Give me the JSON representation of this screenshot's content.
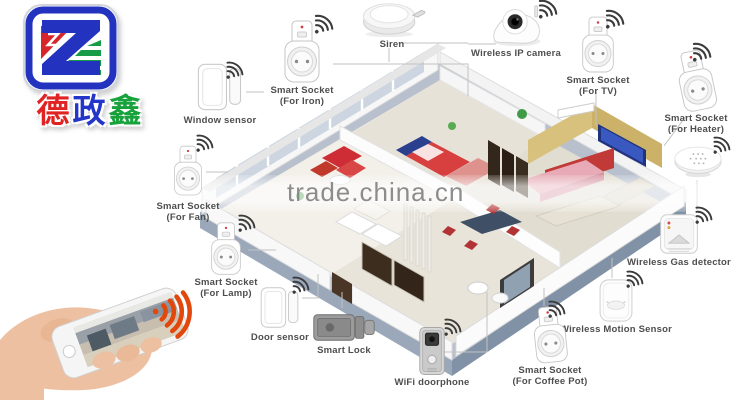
{
  "logo": {
    "letters": "ZX",
    "chars": [
      "德",
      "政",
      "鑫"
    ],
    "colors": {
      "red": "#e02323",
      "blue": "#2336c9",
      "green": "#17a23c"
    }
  },
  "watermark": {
    "text": "trade.china.cn"
  },
  "colors": {
    "wifi_icon": "#3b3b3b",
    "phone_signal": "#e2470b",
    "house_slab": "#b7c0cc"
  },
  "devices": {
    "window_sensor": {
      "label": "Window sensor"
    },
    "socket_iron": {
      "label": "Smart Socket\n(For Iron)"
    },
    "siren": {
      "label": "Siren"
    },
    "ip_camera": {
      "label": "Wireless IP camera"
    },
    "socket_tv": {
      "label": "Smart Socket\n(For TV)"
    },
    "socket_heater": {
      "label": "Smart Socket\n(For Heater)"
    },
    "gas_detector": {
      "label": "Wireless Gas detector"
    },
    "motion_sensor": {
      "label": "Wireless Motion Sensor"
    },
    "socket_coffee": {
      "label": "Smart Socket\n(For Coffee Pot)"
    },
    "wifi_doorphone": {
      "label": "WiFi doorphone"
    },
    "smart_lock": {
      "label": "Smart Lock"
    },
    "door_sensor": {
      "label": "Door sensor"
    },
    "socket_lamp": {
      "label": "Smart Socket\n(For Lamp)"
    },
    "socket_fan": {
      "label": "Smart Socket\n(For Fan)"
    }
  }
}
